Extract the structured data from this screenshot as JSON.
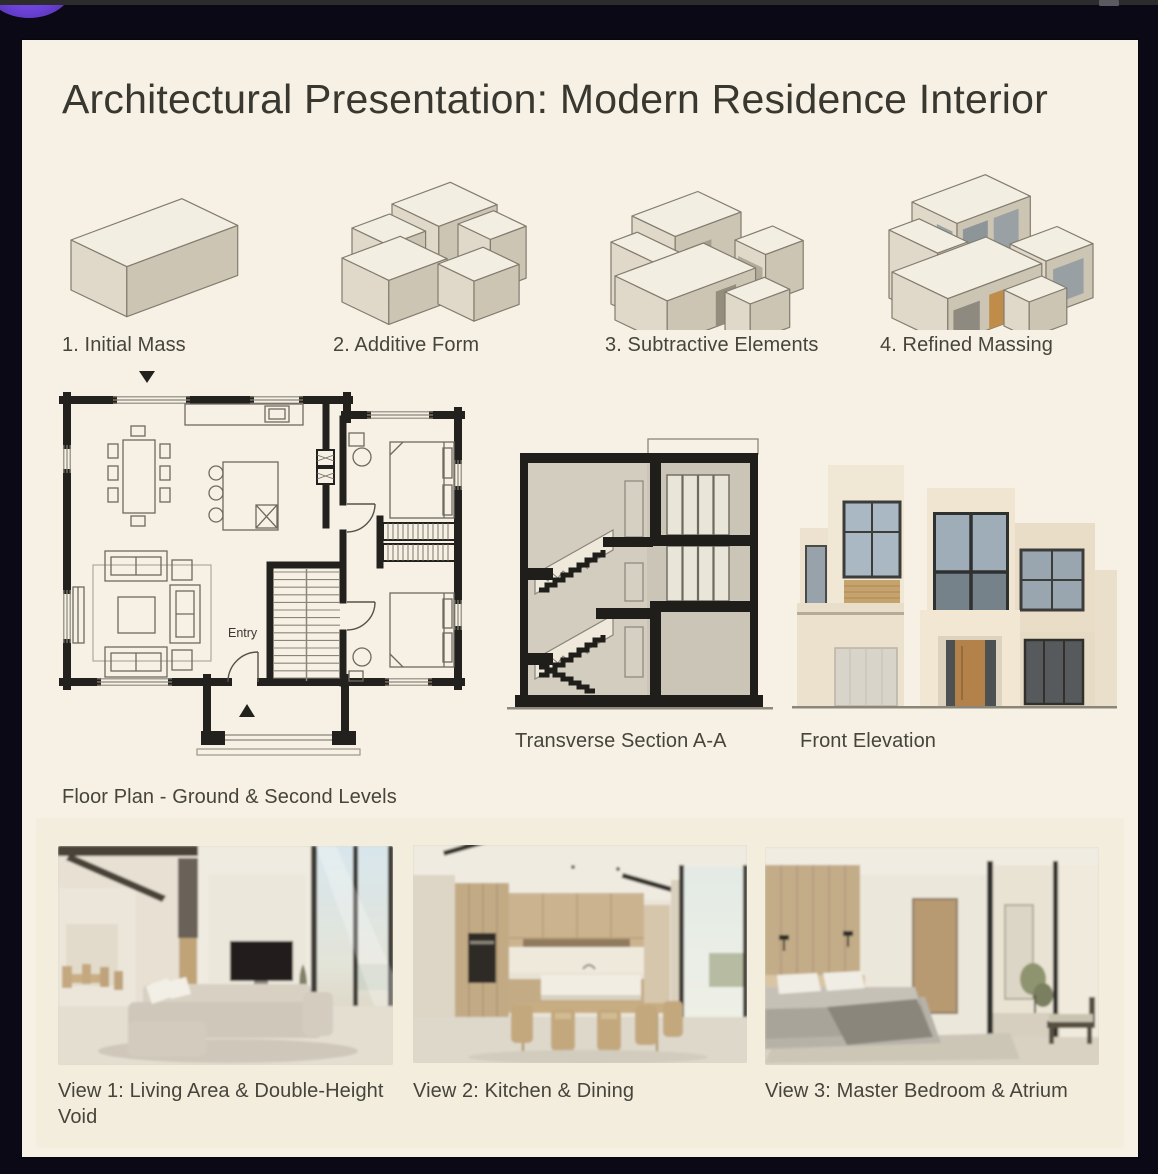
{
  "chrome": {
    "topbar_color": "#2c2c2c",
    "background_color": "#0b0916",
    "accent_circle_color": "#6c42d8"
  },
  "board": {
    "background_color": "#f6f1e4",
    "title": "Architectural Presentation: Modern Residence Interior"
  },
  "massing_steps": [
    {
      "label": "1. Initial Mass"
    },
    {
      "label": "2. Additive Form"
    },
    {
      "label": "3. Subtractive Elements"
    },
    {
      "label": "4. Refined Massing"
    }
  ],
  "floor_plan": {
    "caption": "Floor Plan - Ground & Second Levels",
    "entry_label": "Entry"
  },
  "section": {
    "caption": "Transverse Section A-A"
  },
  "elevation": {
    "caption": "Front Elevation"
  },
  "views": [
    {
      "caption": "View 1: Living Area & Double-Height Void"
    },
    {
      "caption": "View 2: Kitchen & Dining"
    },
    {
      "caption": "View 3: Master Bedroom & Atrium"
    }
  ]
}
